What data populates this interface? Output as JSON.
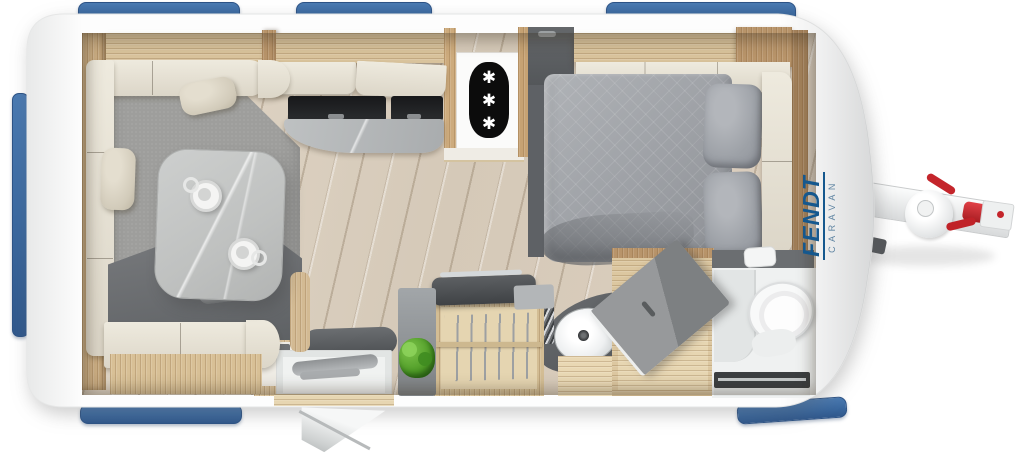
{
  "brand": {
    "name": "FENDT",
    "subtitle": "CARAVAN"
  },
  "fridge": {
    "icon": "snowflake-asterisk-icon",
    "glyphs": [
      "✱",
      "✱",
      "✱"
    ]
  },
  "colors": {
    "window_blue": "#3E6DA5",
    "brand_blue": "#15588E",
    "brand_subtitle": "#5F84A2",
    "hitch_red": "#C4252B",
    "wood_trim": "#D9C39C",
    "floor_wood": "#DDD2C2",
    "carpet_gray": "#9E9E9C",
    "sofa_cream": "#E8E3D8",
    "upholstery_dark": "#65686C",
    "bed_gray": "#A6A9AD",
    "counter_gray": "#B6B9BB",
    "plant_green": "#55A32E",
    "body_white": "#FDFDFD"
  }
}
